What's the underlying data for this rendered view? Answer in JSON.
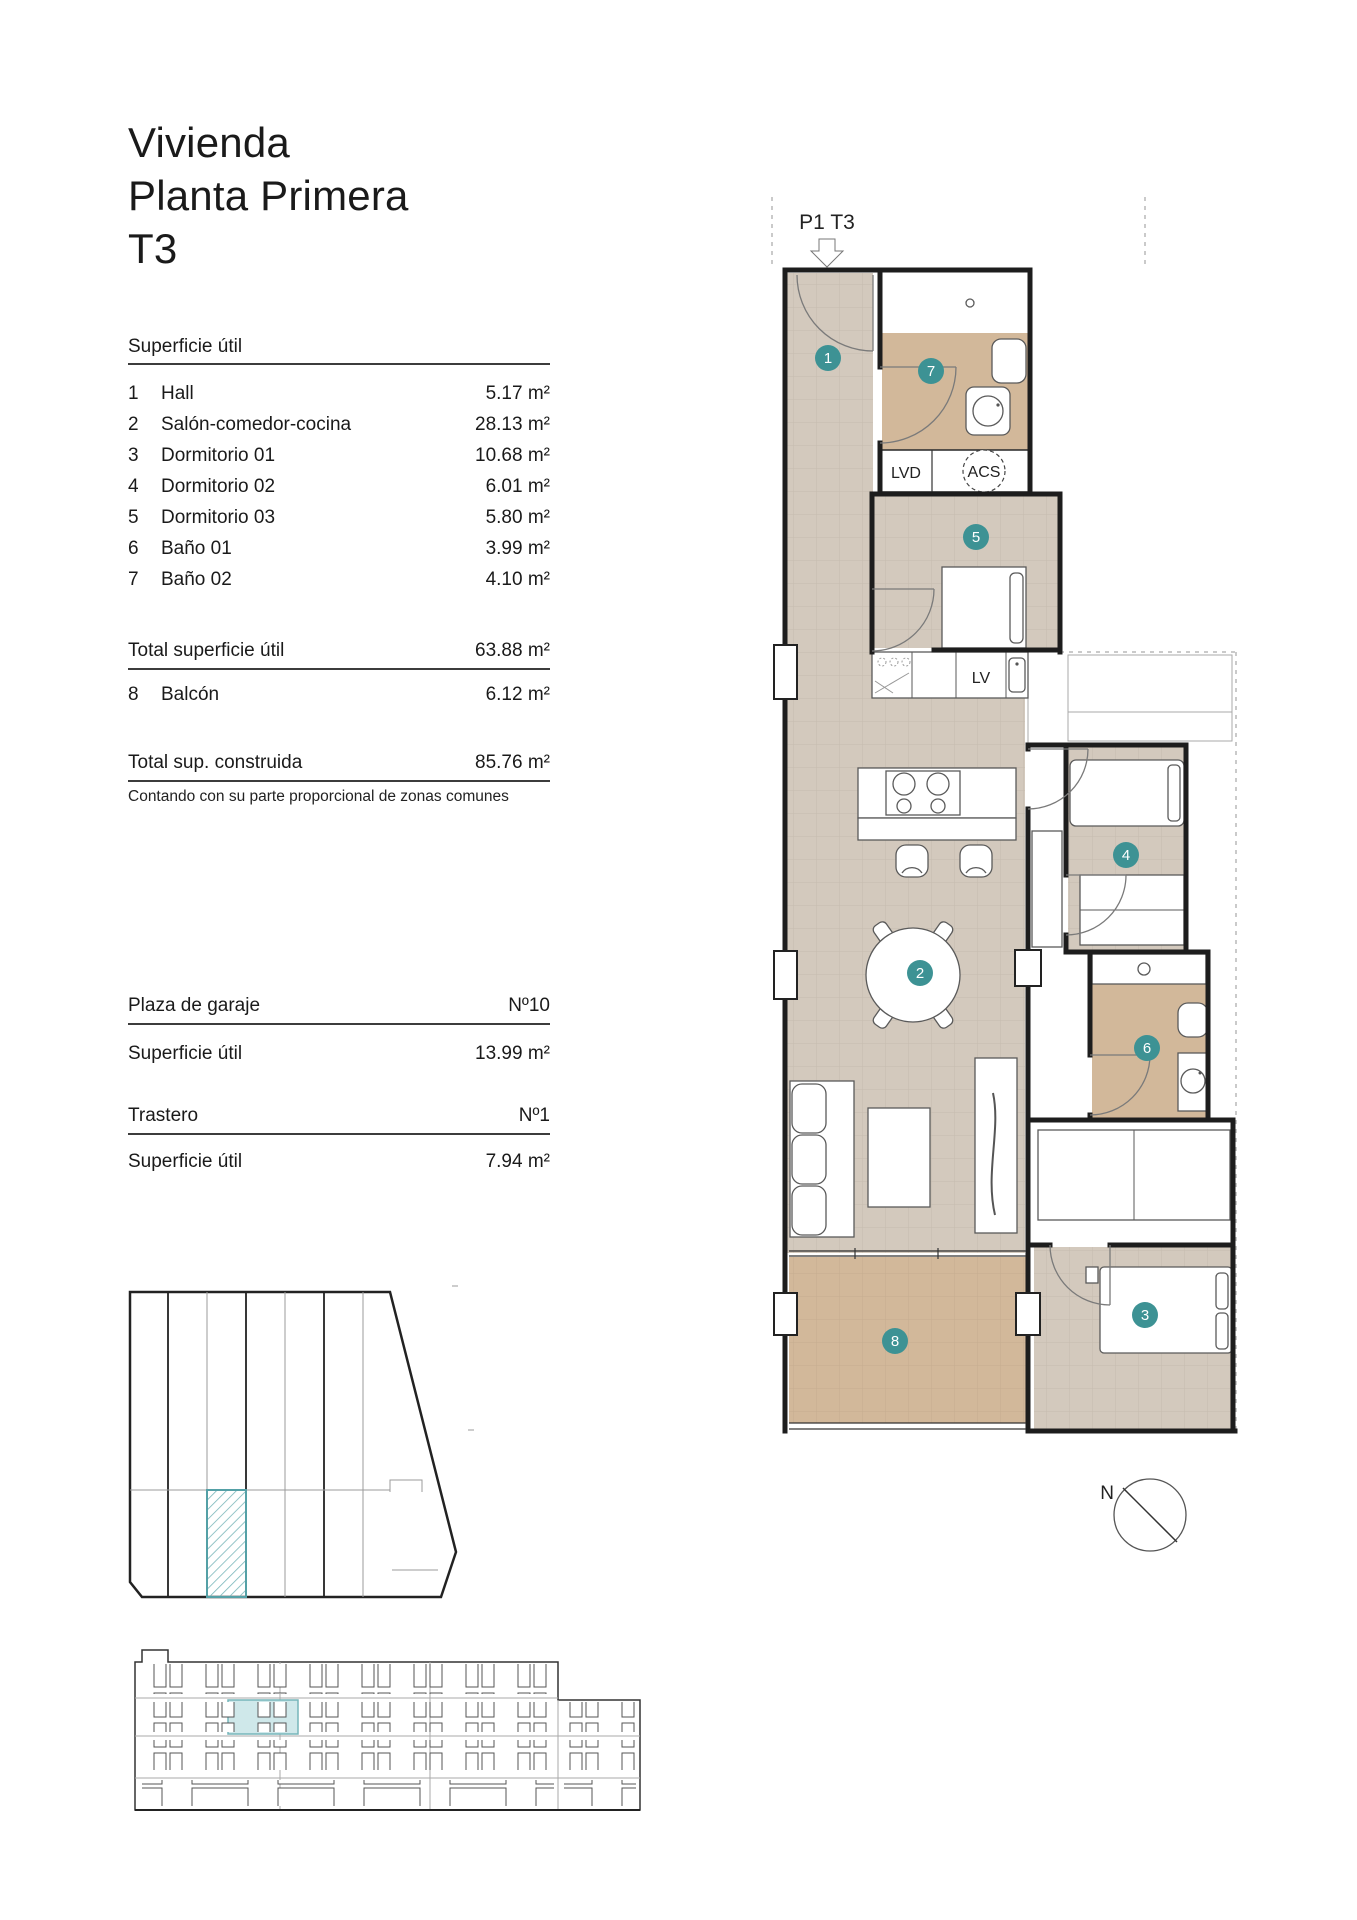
{
  "title": {
    "line1": "Vivienda",
    "line2": "Planta Primera",
    "line3": "T3"
  },
  "surface_table": {
    "heading": "Superficie útil",
    "rows": [
      {
        "num": "1",
        "name": "Hall",
        "value": "5.17 m²"
      },
      {
        "num": "2",
        "name": "Salón-comedor-cocina",
        "value": "28.13 m²"
      },
      {
        "num": "3",
        "name": "Dormitorio 01",
        "value": "10.68 m²"
      },
      {
        "num": "4",
        "name": "Dormitorio 02",
        "value": "6.01 m²"
      },
      {
        "num": "5",
        "name": "Dormitorio 03",
        "value": "5.80 m²"
      },
      {
        "num": "6",
        "name": "Baño 01",
        "value": "3.99 m²"
      },
      {
        "num": "7",
        "name": "Baño 02",
        "value": "4.10 m²"
      }
    ],
    "total_label": "Total superficie útil",
    "total_value": "63.88 m²",
    "balcony_row": {
      "num": "8",
      "name": "Balcón",
      "value": "6.12 m²"
    },
    "built_label": "Total sup. construida",
    "built_value": "85.76 m²",
    "note": "Contando con su parte proporcional de zonas comunes"
  },
  "garage": {
    "heading": "Plaza de garaje",
    "number": "Nº10",
    "area_label": "Superficie útil",
    "area_value": "13.99 m²"
  },
  "storage": {
    "heading": "Trastero",
    "number": "Nº1",
    "area_label": "Superficie útil",
    "area_value": "7.94 m²"
  },
  "plan": {
    "unit_label": "P1 T3",
    "badges": [
      "1",
      "2",
      "3",
      "4",
      "5",
      "6",
      "7",
      "8"
    ],
    "labels": {
      "lvd": "LVD",
      "acs": "ACS",
      "lv": "LV"
    },
    "north_label": "N",
    "colors": {
      "floor_light": "#d3c9bd",
      "floor_tan": "#d2b89a",
      "badge": "#3d9294",
      "highlight": "#cfe8ea",
      "hatch": "#79b6ba"
    }
  }
}
